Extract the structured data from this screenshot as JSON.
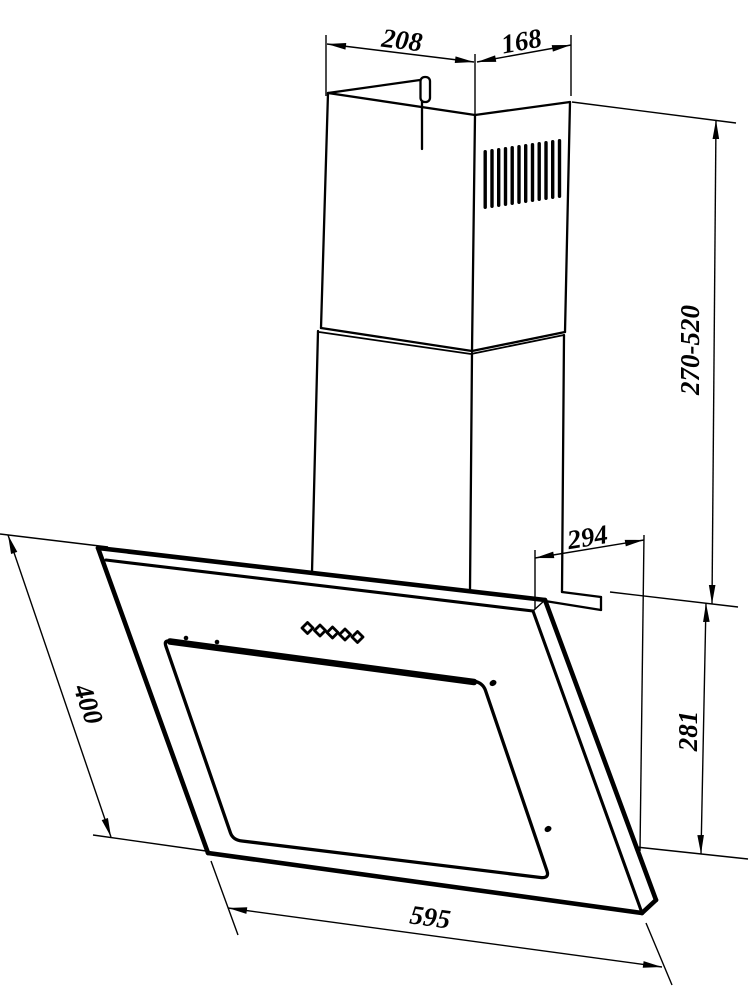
{
  "drawing": {
    "subject": "angled chimney cooker hood dimensional drawing",
    "line_color": "#000000",
    "background_color": "#ffffff"
  },
  "dimensions": {
    "chimney_front_width": "208",
    "chimney_side_depth": "168",
    "chimney_height_range": "270-520",
    "hood_top_depth": "294",
    "hood_right_side_height": "281",
    "hood_front_panel_length": "400",
    "hood_width": "595"
  },
  "features": {
    "vent_slot_count": 12,
    "control_button_count": 5,
    "screw_count": 2
  }
}
